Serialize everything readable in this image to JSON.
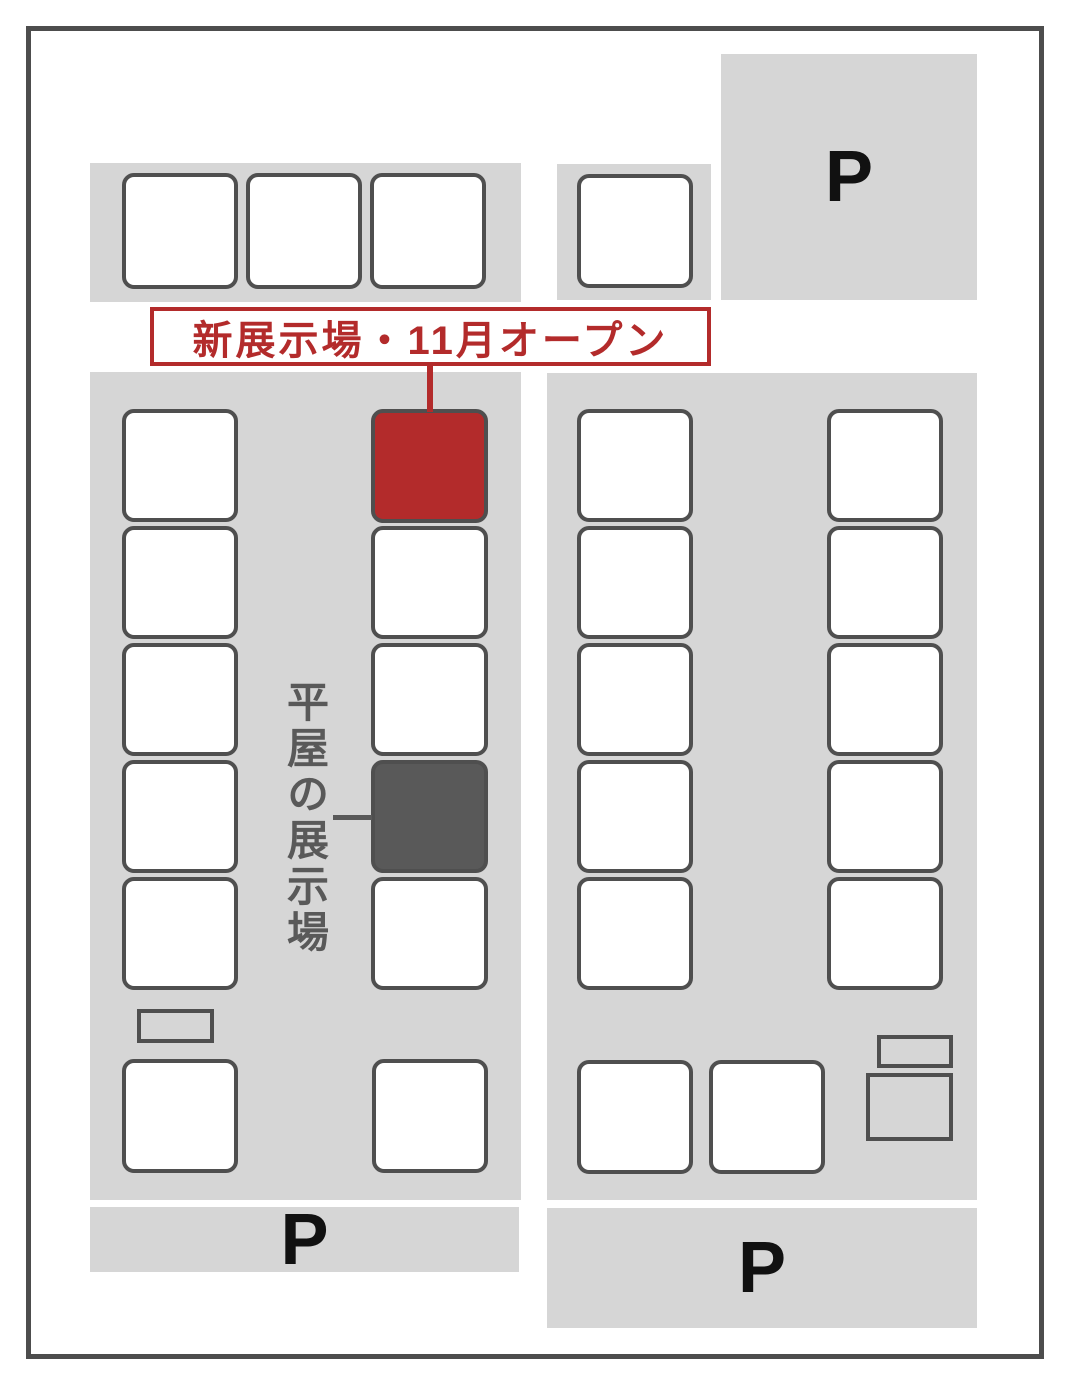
{
  "map": {
    "new_site_label": "新展示場・11月オープン",
    "hiraya_label": "平屋の展示場",
    "parking_letter": "P",
    "parking_areas": 3,
    "lots": {
      "standard_white": 26,
      "new_exhibition_red": 1,
      "hiraya_dark": 1,
      "small_outline_rects": 3
    },
    "colors": {
      "block_bg": "#d6d6d6",
      "lot_border": "#4f4f4f",
      "outline": "#4d4d4d",
      "red": "#b32b2b",
      "dark": "#595959",
      "text": "#111111"
    }
  }
}
